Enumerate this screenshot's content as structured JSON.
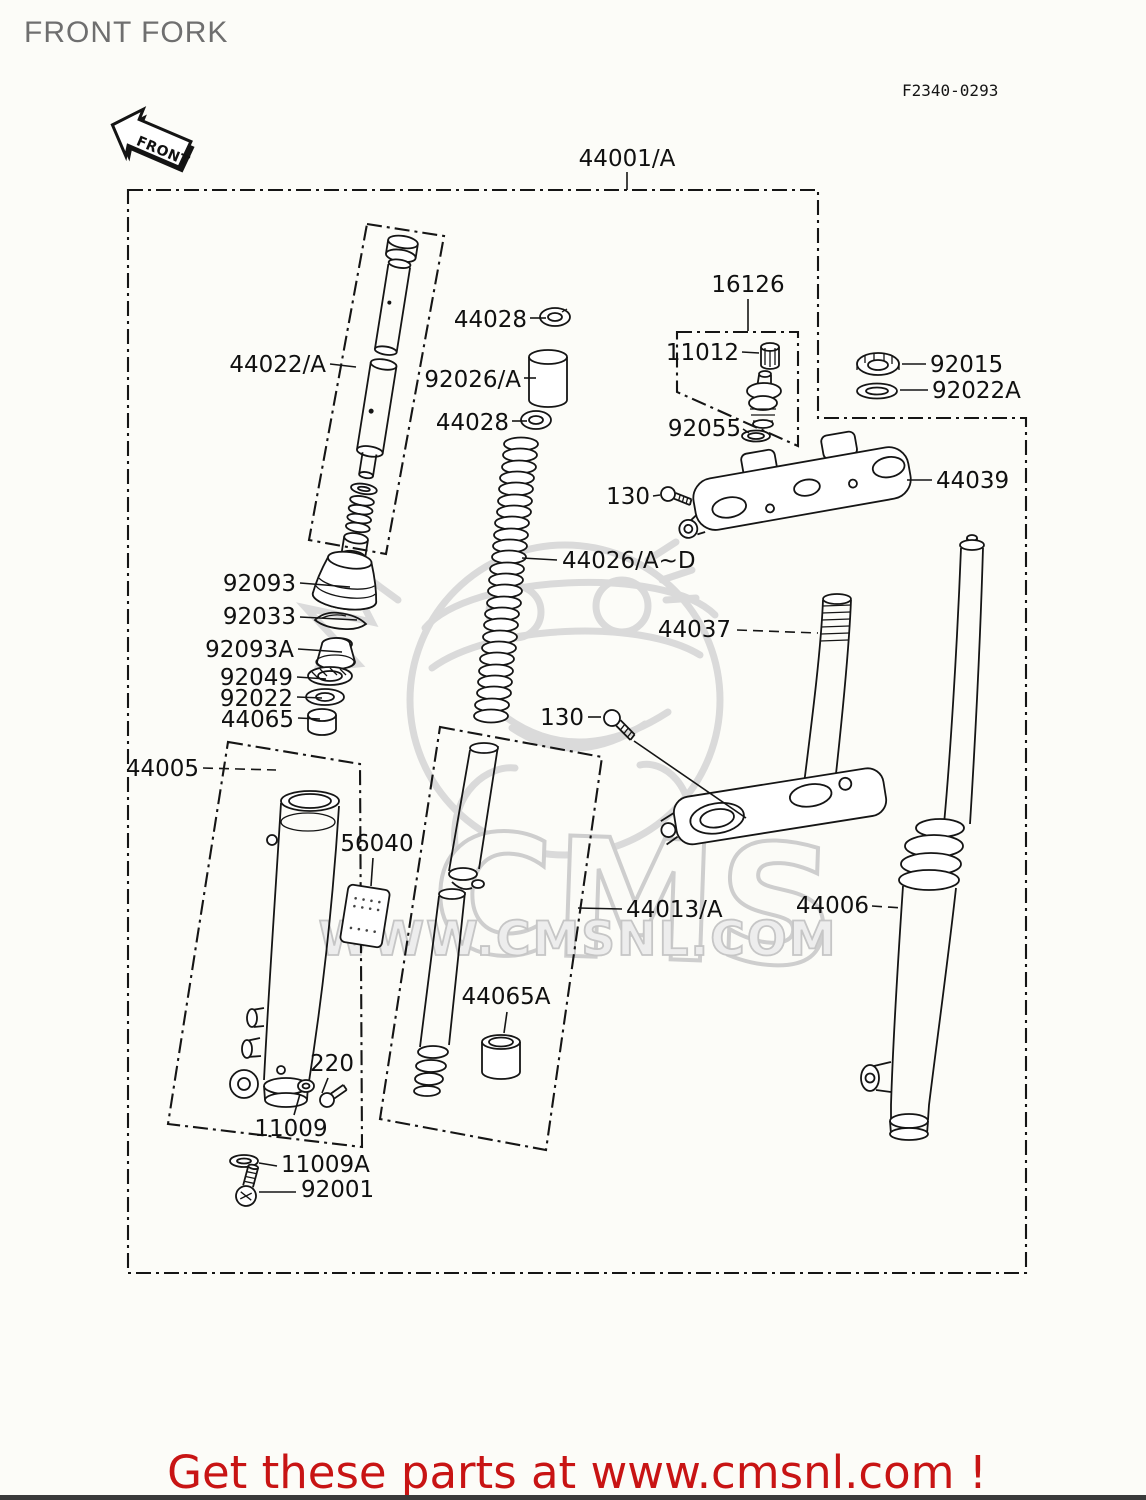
{
  "header": {
    "title": "FRONT FORK",
    "figure_code": "F2340-0293",
    "front_arrow": "FRONT"
  },
  "watermark": {
    "brand": "CMS",
    "url": "WWW.CMSNL.COM"
  },
  "footer": {
    "promo": "Get these parts at www.cmsnl.com !"
  },
  "colors": {
    "title_gray": "#6f6f6f",
    "promo_red": "#c81414",
    "watermark_gray": "#d9d9d9",
    "line_black": "#151515",
    "background": "#fcfcf8"
  },
  "labels": [
    {
      "text": "44001/A"
    },
    {
      "text": "44022/A"
    },
    {
      "text": "44028"
    },
    {
      "text": "92026/A"
    },
    {
      "text": "44028"
    },
    {
      "text": "16126"
    },
    {
      "text": "11012"
    },
    {
      "text": "92055"
    },
    {
      "text": "92015"
    },
    {
      "text": "92022A"
    },
    {
      "text": "44039"
    },
    {
      "text": "130"
    },
    {
      "text": "44026/A~D"
    },
    {
      "text": "44037"
    },
    {
      "text": "130"
    },
    {
      "text": "92093"
    },
    {
      "text": "92033"
    },
    {
      "text": "92093A"
    },
    {
      "text": "92049"
    },
    {
      "text": "92022"
    },
    {
      "text": "44065"
    },
    {
      "text": "44005"
    },
    {
      "text": "56040"
    },
    {
      "text": "44013/A"
    },
    {
      "text": "44006"
    },
    {
      "text": "44065A"
    },
    {
      "text": "220"
    },
    {
      "text": "11009"
    },
    {
      "text": "11009A"
    },
    {
      "text": "92001"
    }
  ]
}
